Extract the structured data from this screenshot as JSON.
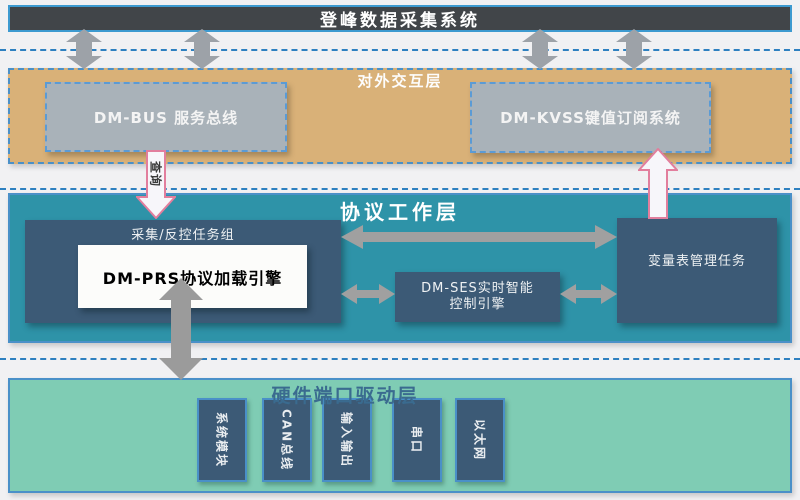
{
  "title_bar": {
    "label": "登峰数据采集系统"
  },
  "layers": {
    "interaction": {
      "title": "对外交互层",
      "bus_box": {
        "label": "DM-BUS 服务总线"
      },
      "kvss_box": {
        "label": "DM-KVSS键值订阅系统"
      }
    },
    "protocol": {
      "title": "协议工作层",
      "task_group": {
        "label": "采集/反控任务组"
      },
      "prs_engine": {
        "label": "DM-PRS协议加载引擎"
      },
      "ses_engine": {
        "line1": "DM-SES实时智能",
        "line2": "控制引擎"
      },
      "var_table": {
        "label": "变量表管理任务"
      }
    },
    "hardware": {
      "title": "硬件端口驱动层",
      "ports": [
        "系统模块",
        "CAN总线",
        "输入输出",
        "串口",
        "以太网"
      ]
    }
  },
  "arrows": {
    "bus_down_label": "查询"
  },
  "colors": {
    "top_bar": "#414549",
    "accent_blue": "#4a90c8",
    "dashed_blue": "#2e80c0",
    "tan_layer": "#d9b178",
    "gray_box": "#a9b2b9",
    "teal_layer": "#2e93a8",
    "slate_box": "#3c5a76",
    "green_layer": "#7fccb4",
    "gray_arrow": "#9da2a8",
    "pink_arrow_border": "#e27e9d"
  }
}
